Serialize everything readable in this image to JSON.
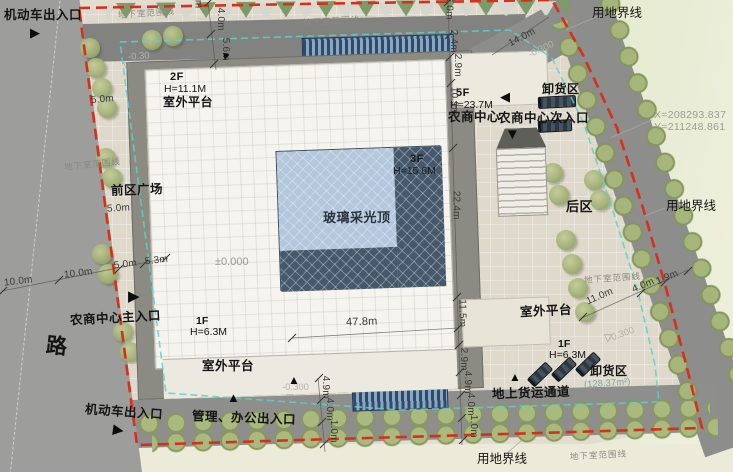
{
  "site": {
    "road_label": "路",
    "boundary_label": "用地界线",
    "underground_label": "地下室范围线",
    "coordinate_x": "X=208293.837",
    "coordinate_y": "Y=211248.861"
  },
  "areas": {
    "front_plaza": "前区广场",
    "rear_area": "后区",
    "skylight": "玻璃采光顶",
    "unloading_top": "卸货区",
    "unloading_bottom": "卸货区",
    "unloading_bottom_area": "(128.37m²)",
    "freight_passage": "地上货运通道",
    "platform_sw": "室外平台",
    "platform_se": "室外平台"
  },
  "entrances": {
    "vehicle_top": "机动车出入口",
    "vehicle_bottom": "机动车出入口",
    "main": "农商中心主入口",
    "secondary": "农商中心次入口",
    "admin": "管理、办公出入口"
  },
  "floors": {
    "f2": {
      "level": "2F",
      "height": "H=11.1M",
      "name": "室外平台"
    },
    "f3": {
      "level": "3F",
      "height": "H=15.6M"
    },
    "f5": {
      "level": "5F",
      "height": "H=23.7M",
      "name": "农商中心"
    },
    "f1_left": {
      "level": "1F",
      "height": "H=6.3M"
    },
    "f1_right": {
      "level": "1F",
      "height": "H=6.3M"
    }
  },
  "elevations": {
    "zero": "±0.000",
    "nw": "-0.30",
    "ne": "-0.300",
    "south": "-0.300",
    "east": "-0.300"
  },
  "dimensions": {
    "left_chain": [
      "2m",
      "4.0m",
      "5.6m"
    ],
    "plaza_chain": [
      "10.0m",
      "10.0m",
      "5.0m",
      "5.3m"
    ],
    "plaza_width_upper": "5.0m",
    "plaza_width_mid": "5.0m",
    "top_chain": [
      "26.0m",
      "2.4m",
      "2.9m",
      "10.9m"
    ],
    "right_chain": [
      "22.4m",
      "11.5m",
      "2.9m",
      "4.9m",
      "4.0m",
      "1.0m"
    ],
    "south_chain": [
      "4.9m",
      "4.0m",
      "1.0m"
    ],
    "building_width": "47.8m",
    "road_ne": "14.0m",
    "road_east": [
      "11.0m",
      "4.0m",
      "1.9m"
    ]
  },
  "icons": {
    "arrow_right": "▶",
    "arrow_left": "◀",
    "arrow_up": "▲",
    "arrow_down": "▼",
    "triangle_open": "▽"
  },
  "colors": {
    "boundary_red": "#d6301a",
    "underground_teal": "#5ad2c6",
    "skylight_light": "#b4c7dc",
    "skylight_dark": "#46586c"
  }
}
